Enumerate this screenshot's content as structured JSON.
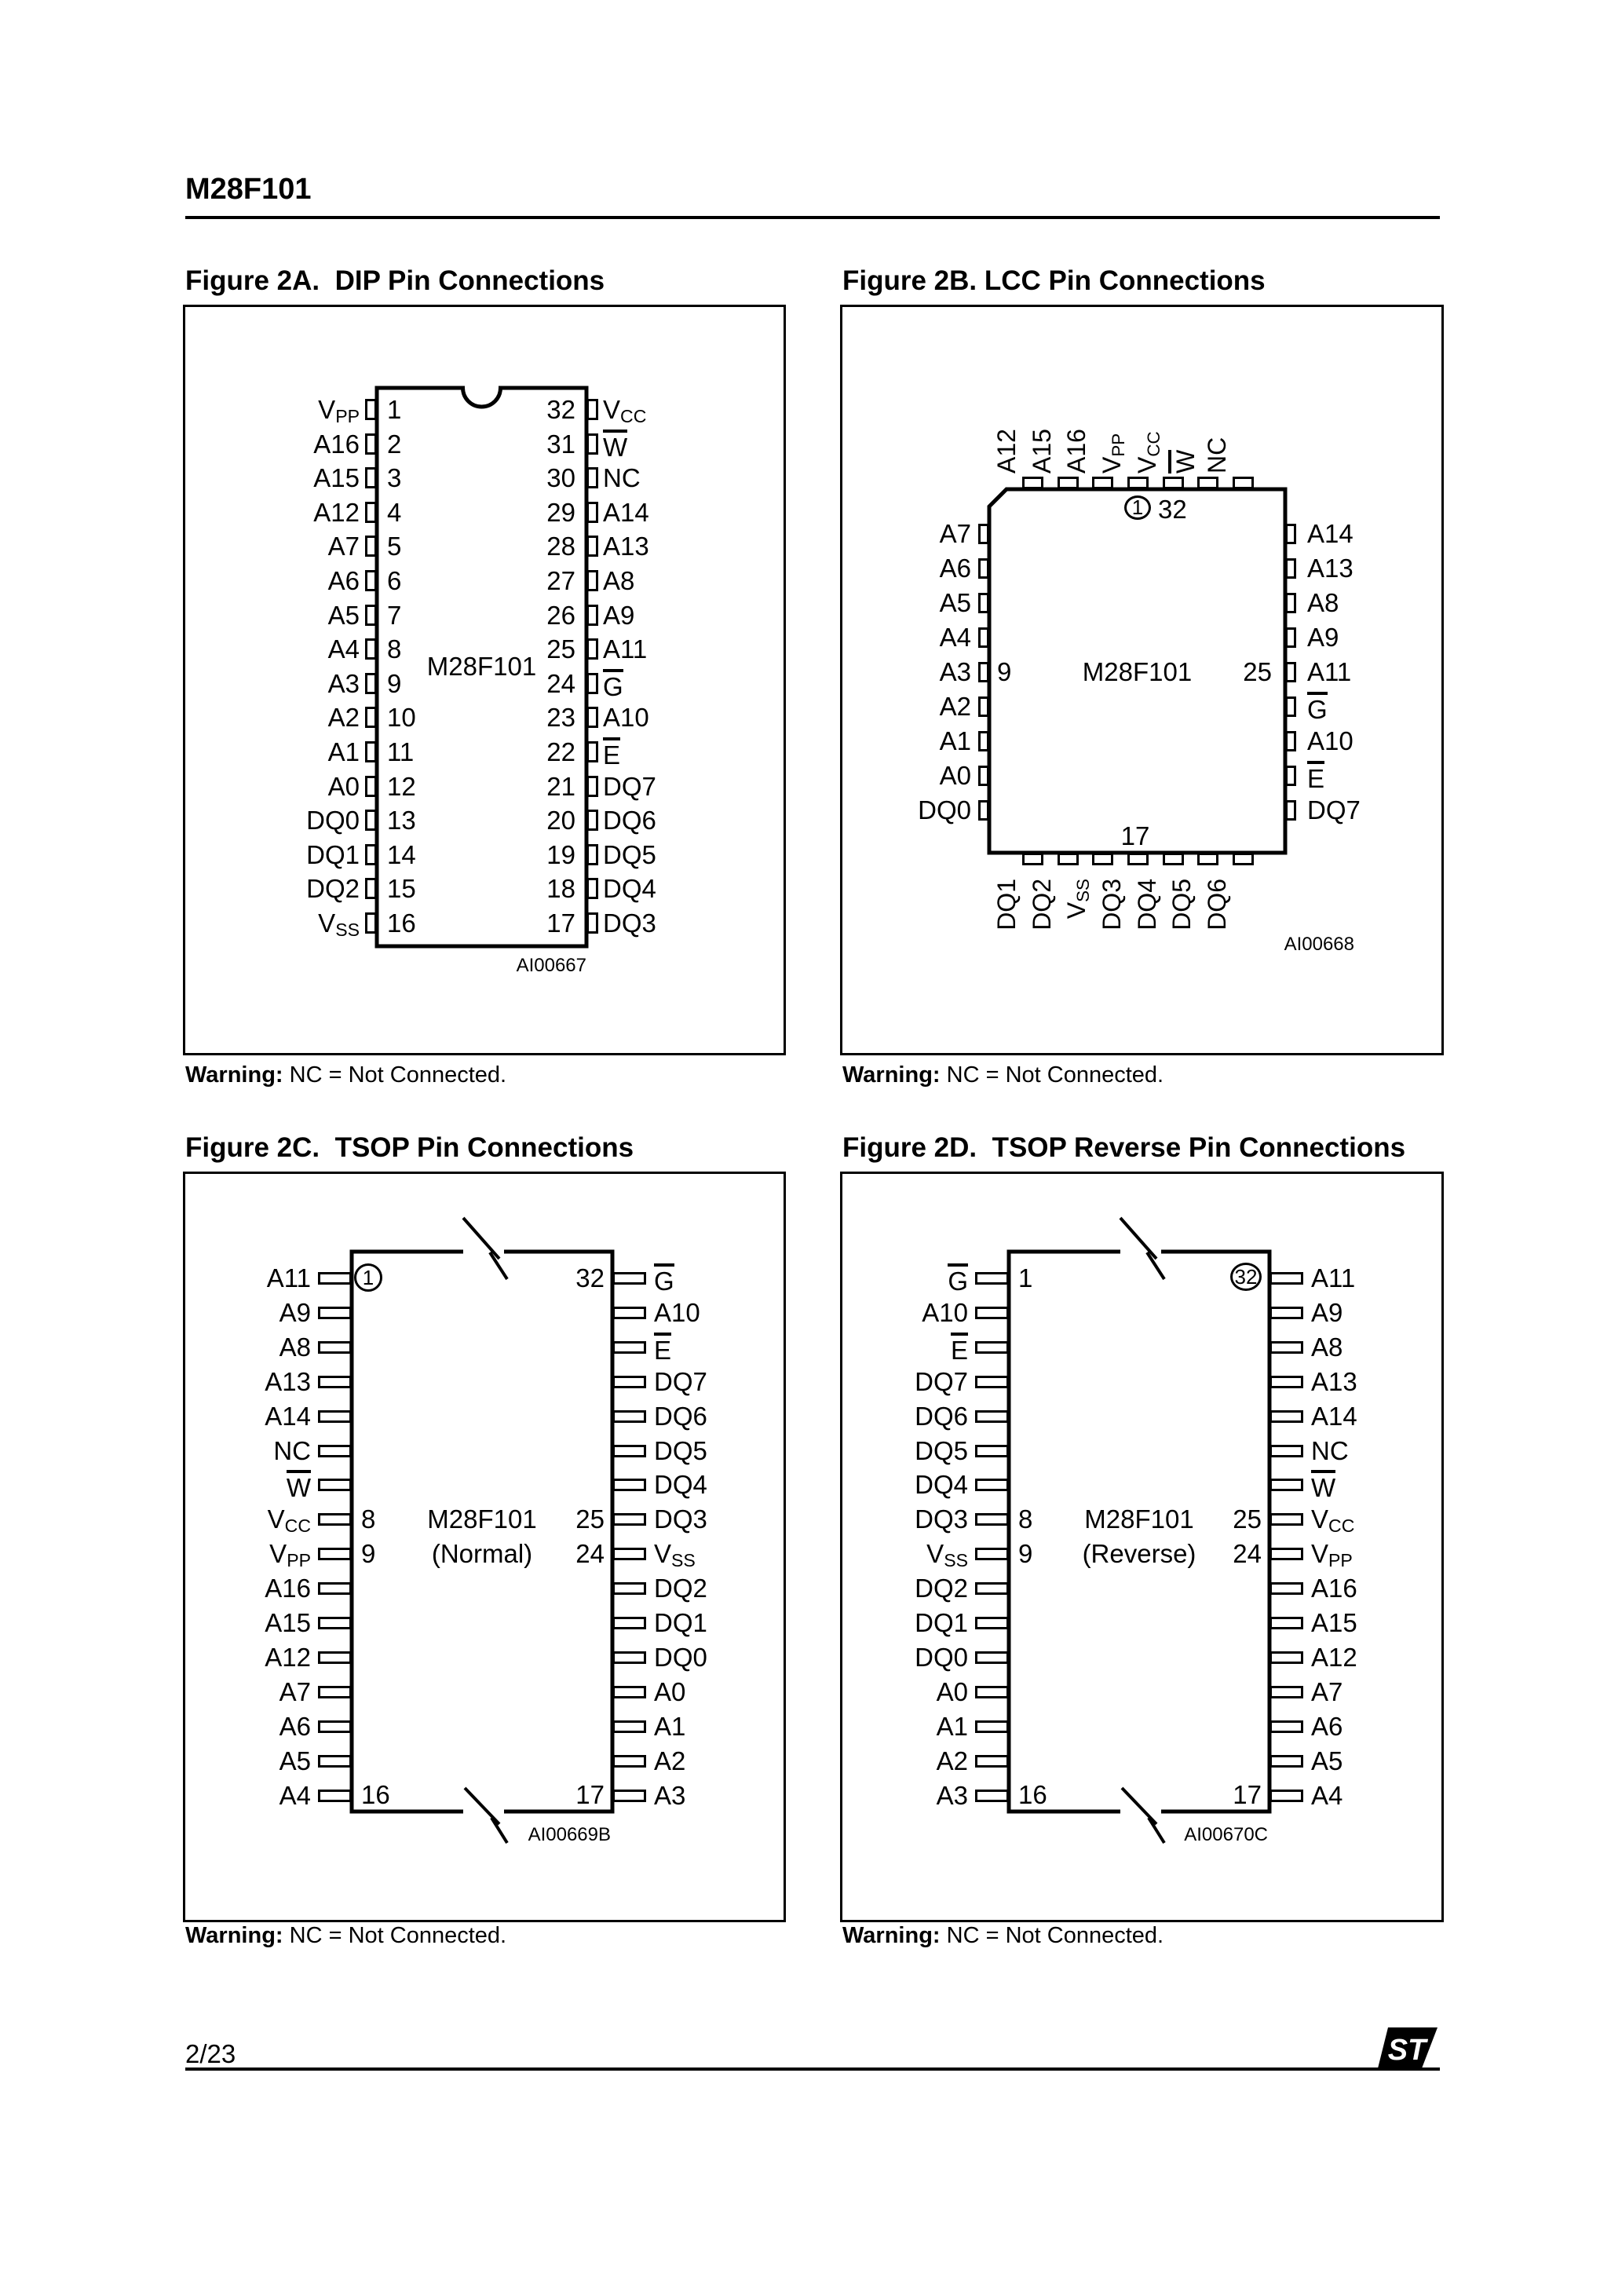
{
  "page": {
    "title": "M28F101",
    "page_number": "2/23",
    "logo_text": "ST"
  },
  "warning": {
    "label": "Warning:",
    "text": " NC = Not Connected."
  },
  "figures": {
    "fig2a": {
      "title": "Figure 2A.  DIP Pin Connections",
      "chip": "M28F101",
      "ref": "AI00667",
      "left": [
        {
          "pin": "V|PP",
          "num": "1"
        },
        {
          "pin": "A16",
          "num": "2"
        },
        {
          "pin": "A15",
          "num": "3"
        },
        {
          "pin": "A12",
          "num": "4"
        },
        {
          "pin": "A7",
          "num": "5"
        },
        {
          "pin": "A6",
          "num": "6"
        },
        {
          "pin": "A5",
          "num": "7"
        },
        {
          "pin": "A4",
          "num": "8"
        },
        {
          "pin": "A3",
          "num": "9"
        },
        {
          "pin": "A2",
          "num": "10"
        },
        {
          "pin": "A1",
          "num": "11"
        },
        {
          "pin": "A0",
          "num": "12"
        },
        {
          "pin": "DQ0",
          "num": "13"
        },
        {
          "pin": "DQ1",
          "num": "14"
        },
        {
          "pin": "DQ2",
          "num": "15"
        },
        {
          "pin": "V|SS",
          "num": "16"
        }
      ],
      "right": [
        {
          "pin": "V|CC",
          "num": "32"
        },
        {
          "pin": "^W",
          "num": "31"
        },
        {
          "pin": "NC",
          "num": "30"
        },
        {
          "pin": "A14",
          "num": "29"
        },
        {
          "pin": "A13",
          "num": "28"
        },
        {
          "pin": "A8",
          "num": "27"
        },
        {
          "pin": "A9",
          "num": "26"
        },
        {
          "pin": "A11",
          "num": "25"
        },
        {
          "pin": "^G",
          "num": "24"
        },
        {
          "pin": "A10",
          "num": "23"
        },
        {
          "pin": "^E",
          "num": "22"
        },
        {
          "pin": "DQ7",
          "num": "21"
        },
        {
          "pin": "DQ6",
          "num": "20"
        },
        {
          "pin": "DQ5",
          "num": "19"
        },
        {
          "pin": "DQ4",
          "num": "18"
        },
        {
          "pin": "DQ3",
          "num": "17"
        }
      ]
    },
    "fig2b": {
      "title": "Figure 2B. LCC Pin Connections",
      "chip": "M28F101",
      "ref": "AI00668",
      "top_pins": [
        "A12",
        "A15",
        "A16",
        "V|PP",
        "V|CC",
        "^W",
        "NC"
      ],
      "left_pins": [
        "A7",
        "A6",
        "A5",
        "A4",
        "A3",
        "A2",
        "A1",
        "A0",
        "DQ0"
      ],
      "right_pins": [
        "A14",
        "A13",
        "A8",
        "A9",
        "A11",
        "^G",
        "A10",
        "^E",
        "DQ7"
      ],
      "bottom_pins": [
        "DQ1",
        "DQ2",
        "V|SS",
        "DQ3",
        "DQ4",
        "DQ5",
        "DQ6"
      ],
      "corner_pin_number": "1",
      "top_right_number": "32",
      "left_number": "9",
      "right_number": "25",
      "bottom_number": "17"
    },
    "fig2c": {
      "title": "Figure 2C.  TSOP Pin Connections",
      "chip": "M28F101",
      "variant": "(Normal)",
      "ref": "AI00669B",
      "left_pins": [
        "A11",
        "A9",
        "A8",
        "A13",
        "A14",
        "NC",
        "^W",
        "V|CC",
        "V|PP",
        "A16",
        "A15",
        "A12",
        "A7",
        "A6",
        "A5",
        "A4"
      ],
      "right_pins": [
        "^G",
        "A10",
        "^E",
        "DQ7",
        "DQ6",
        "DQ5",
        "DQ4",
        "DQ3",
        "V|SS",
        "DQ2",
        "DQ1",
        "DQ0",
        "A0",
        "A1",
        "A2",
        "A3"
      ],
      "numbers": {
        "top_left": "1",
        "top_right": "32",
        "left_mid_upper": "8",
        "left_mid_lower": "9",
        "bottom_left": "16",
        "right_mid_upper": "25",
        "right_mid_lower": "24",
        "bottom_right": "17"
      },
      "circled_number": "top_left"
    },
    "fig2d": {
      "title": "Figure 2D.  TSOP Reverse Pin Connections",
      "chip": "M28F101",
      "variant": "(Reverse)",
      "ref": "AI00670C",
      "left_pins": [
        "^G",
        "A10",
        "^E",
        "DQ7",
        "DQ6",
        "DQ5",
        "DQ4",
        "DQ3",
        "V|SS",
        "DQ2",
        "DQ1",
        "DQ0",
        "A0",
        "A1",
        "A2",
        "A3"
      ],
      "right_pins": [
        "A11",
        "A9",
        "A8",
        "A13",
        "A14",
        "NC",
        "^W",
        "V|CC",
        "V|PP",
        "A16",
        "A15",
        "A12",
        "A7",
        "A6",
        "A5",
        "A4"
      ],
      "numbers": {
        "top_left": "1",
        "top_right": "32",
        "left_mid_upper": "8",
        "left_mid_lower": "9",
        "bottom_left": "16",
        "right_mid_upper": "25",
        "right_mid_lower": "24",
        "bottom_right": "17"
      },
      "circled_number": "top_right"
    }
  }
}
